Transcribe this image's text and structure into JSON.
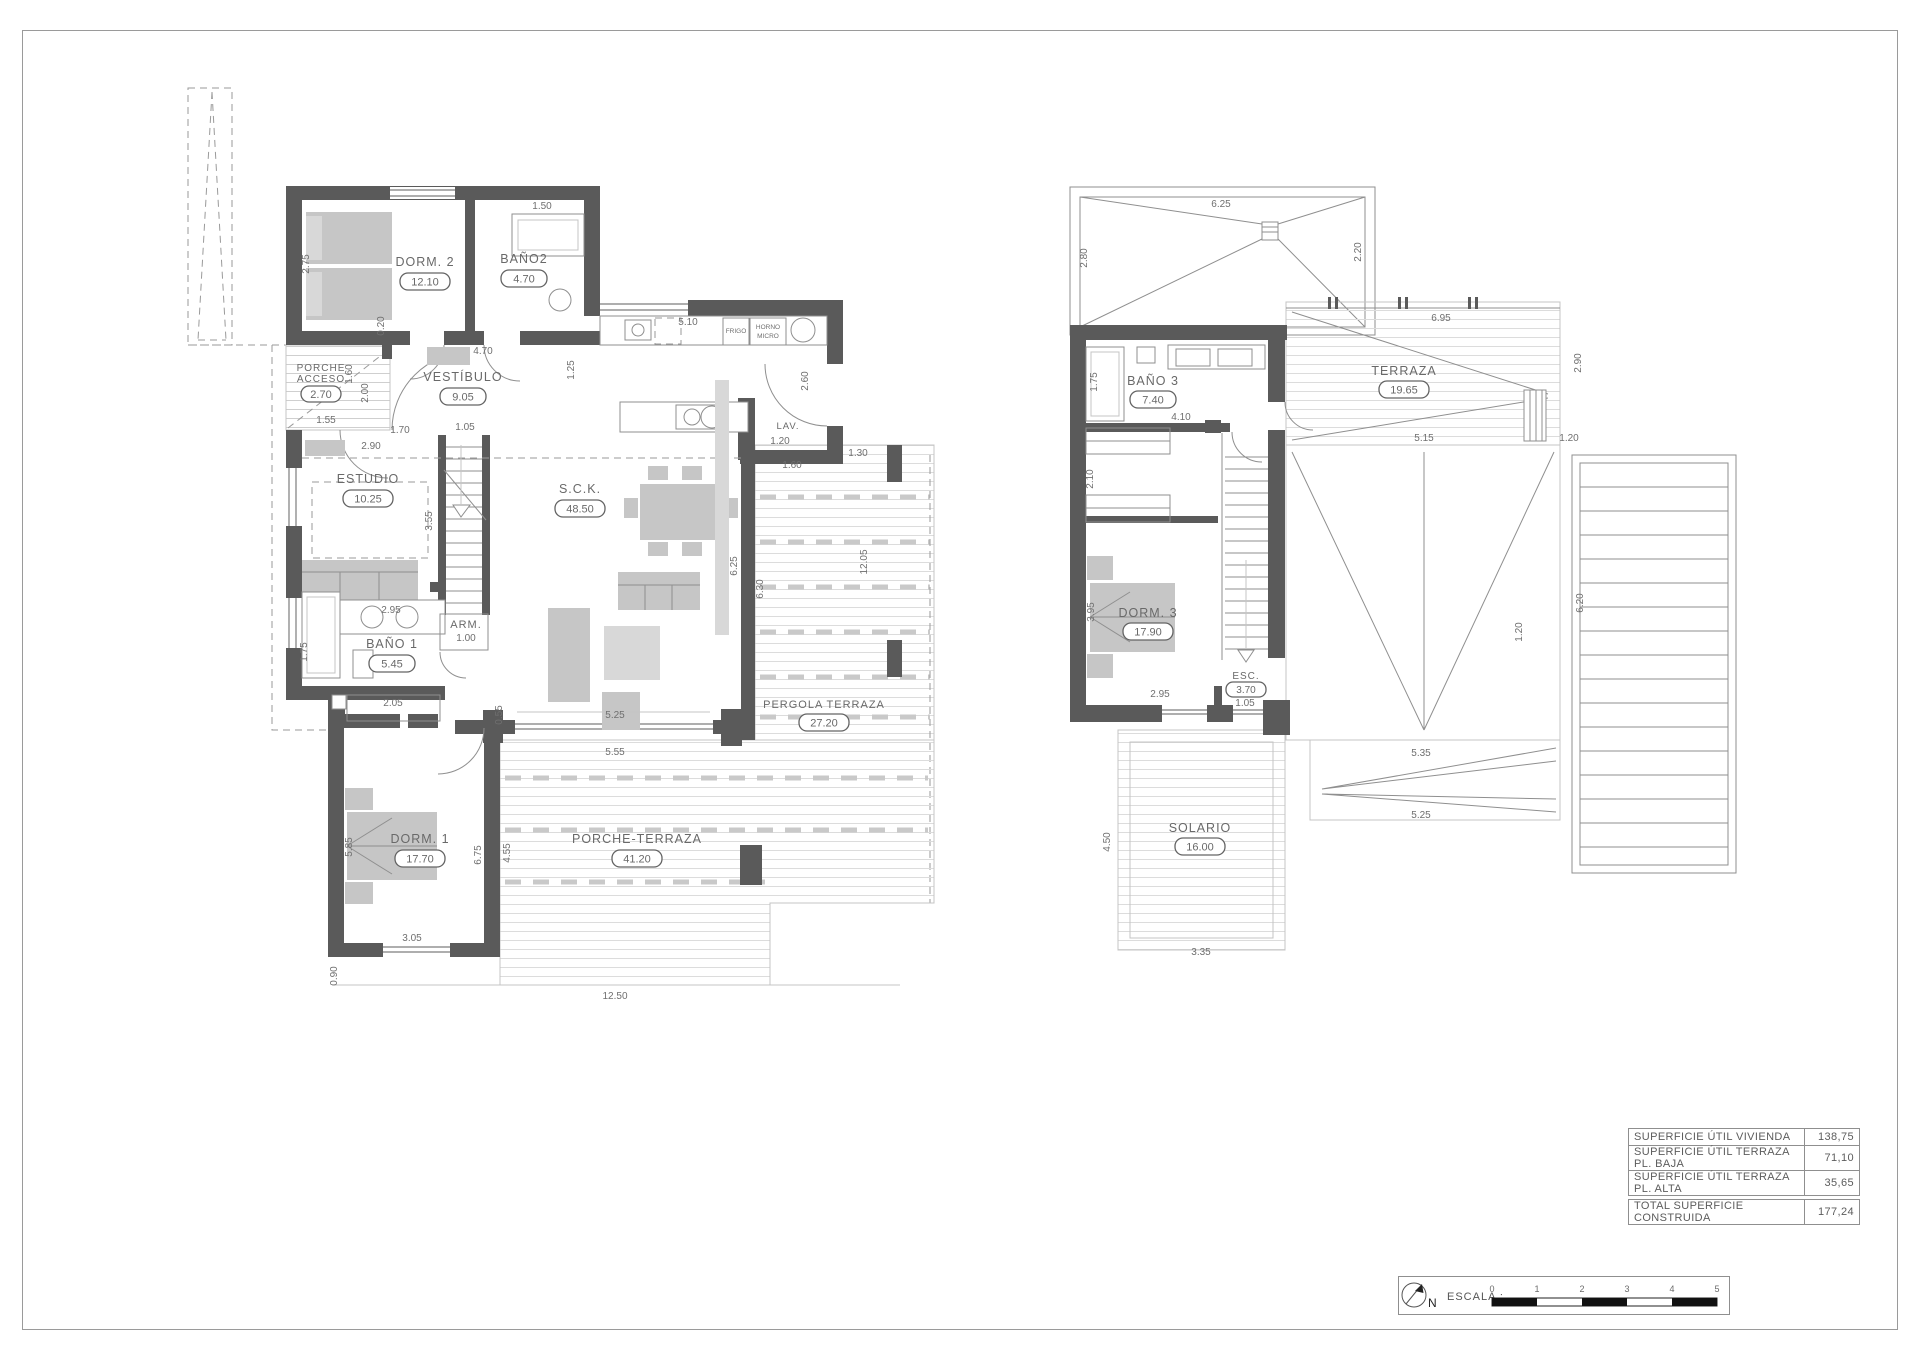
{
  "ground_floor": {
    "rooms": [
      {
        "label": "DORM. 2",
        "area": "12.10"
      },
      {
        "label": "BAÑO2",
        "area": "4.70"
      },
      {
        "label": "VESTÍBULO",
        "area": "9.05"
      },
      {
        "label": "PORCHE",
        "label2": "ACCESO",
        "area": "2.70"
      },
      {
        "label": "ESTUDIO",
        "area": "10.25"
      },
      {
        "label": "S.C.K.",
        "area": "48.50"
      },
      {
        "label": "BAÑO 1",
        "area": "5.45"
      },
      {
        "label": "ARM."
      },
      {
        "label": "DORM. 1",
        "area": "17.70"
      },
      {
        "label": "PERGOLA TERRAZA",
        "area": "27.20"
      },
      {
        "label": "PORCHE-TERRAZA",
        "area": "41.20"
      },
      {
        "label": "LAV."
      }
    ],
    "appliances": [
      "FRIGO",
      "HORNO",
      "MICRO"
    ],
    "dims": [
      "1.50",
      "2.75",
      "0.20",
      "4.70",
      "1.55",
      "1.60",
      "2.00",
      "1.70",
      "2.90",
      "1.05",
      "5.10",
      "1.25",
      "2.60",
      "1.20",
      "1.30",
      "1.60",
      "3.55",
      "2.95",
      "1.75",
      "1.00",
      "2.05",
      "0.55",
      "5.25",
      "5.55",
      "6.25",
      "6.30",
      "12.05",
      "5.85",
      "6.75",
      "4.55",
      "3.05",
      "0.90",
      "12.50"
    ]
  },
  "upper_floor": {
    "rooms": [
      {
        "label": "BAÑO 3",
        "area": "7.40"
      },
      {
        "label": "TERRAZA",
        "area": "19.65"
      },
      {
        "label": "DORM. 3",
        "area": "17.90"
      },
      {
        "label": "ESC.",
        "area": "3.70"
      },
      {
        "label": "SOLARIO",
        "area": "16.00"
      }
    ],
    "dims": [
      "6.25",
      "2.80",
      "2.20",
      "1.75",
      "4.10",
      "6.95",
      "2.10",
      "3.95",
      "2.95",
      "1.05",
      "5.15",
      "1.20",
      "2.90",
      "6.20",
      "5.35",
      "5.25",
      "4.50",
      "3.35",
      "1.20"
    ]
  },
  "summary_table": {
    "rows": [
      {
        "label": "SUPERFICIE ÚTIL VIVIENDA",
        "value": "138,75"
      },
      {
        "label": "SUPERFICIE ÚTIL TERRAZA PL. BAJA",
        "value": "71,10"
      },
      {
        "label": "SUPERFICIE ÚTIL TERRAZA PL. ALTA",
        "value": "35,65"
      }
    ],
    "total": {
      "label": "TOTAL SUPERFICIE CONSTRUIDA",
      "value": "177,24"
    }
  },
  "scale_bar": {
    "north": "N",
    "label": "ESCALA :",
    "ticks": [
      "0",
      "1",
      "2",
      "3",
      "4",
      "5"
    ]
  }
}
